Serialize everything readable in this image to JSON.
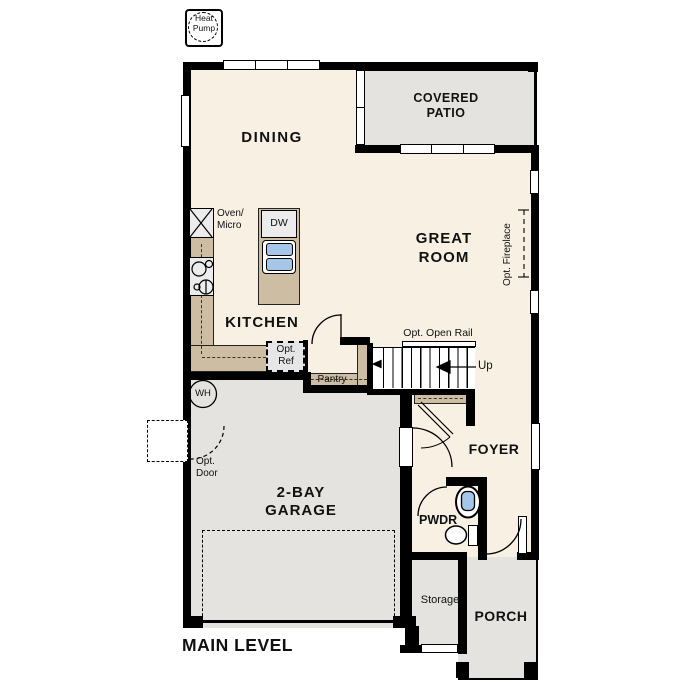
{
  "title": "Floor plan - Main Level",
  "colors": {
    "floor": "#f8f0e2",
    "exterior_space": "#e4e3e0",
    "wood": "#cdbda2",
    "fixture_blue": "#a5c6e8",
    "wall": "#000000"
  },
  "labels": {
    "heat_pump": {
      "line1": "Heat",
      "line2": "Pump"
    },
    "dining": "DINING",
    "covered_patio": {
      "line1": "COVERED",
      "line2": "PATIO"
    },
    "great_room": {
      "line1": "GREAT",
      "line2": "ROOM"
    },
    "kitchen": "KITCHEN",
    "oven_micro": {
      "line1": "Oven/",
      "line2": "Micro"
    },
    "dw": "DW",
    "opt_ref": {
      "line1": "Opt.",
      "line2": "Ref"
    },
    "pantry": "Pantry",
    "opt_open_rail": "Opt. Open Rail",
    "up": "Up",
    "opt_fireplace": "Opt. Fireplace",
    "wh": "WH",
    "opt_door": {
      "line1": "Opt.",
      "line2": "Door"
    },
    "garage": {
      "line1": "2-BAY",
      "line2": "GARAGE"
    },
    "foyer": "FOYER",
    "pwdr": "PWDR",
    "storage": "Storage",
    "porch": "PORCH",
    "main_level": "MAIN LEVEL"
  }
}
